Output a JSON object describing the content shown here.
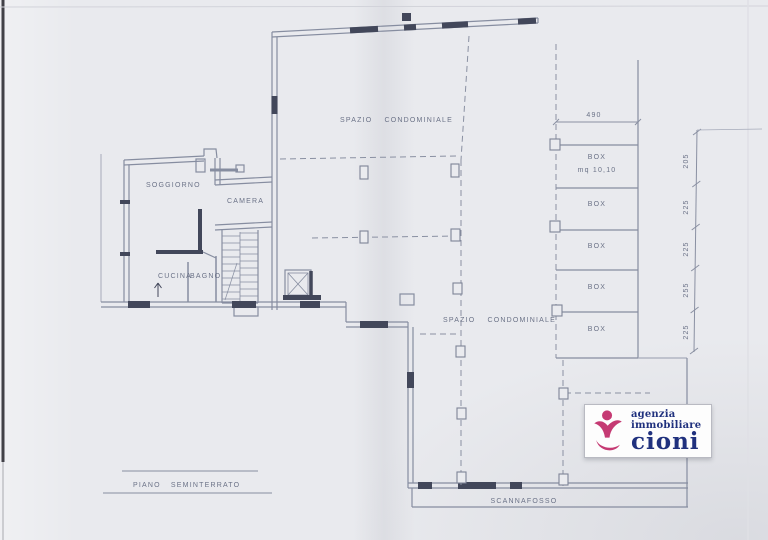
{
  "plan": {
    "title": "PIANO SEMINTERRATO",
    "rooms": {
      "soggiorno": "SOGGIORNO",
      "camera": "CAMERA",
      "cucina": "CUCINA",
      "bagno": "BAGNO"
    },
    "areas": {
      "spazio_upper": "SPAZIO CONDOMINIALE",
      "spazio_lower": "SPAZIO CONDOMINIALE",
      "scannafosso": "SCANNAFOSSO"
    },
    "boxes": [
      {
        "label": "BOX",
        "area": "mq 10,10"
      },
      {
        "label": "BOX",
        "area": ""
      },
      {
        "label": "BOX",
        "area": ""
      },
      {
        "label": "BOX",
        "area": ""
      },
      {
        "label": "BOX",
        "area": ""
      }
    ],
    "dimensions": {
      "top_width": "490",
      "right_heights": [
        "205",
        "225",
        "225",
        "255",
        "225"
      ]
    }
  },
  "logo": {
    "line1": "agenzia",
    "line2": "immobiliare",
    "name": "cioni",
    "colors": {
      "figure": "#c53a73",
      "text": "#20317e"
    }
  },
  "scan": {
    "paper_color": "#e9eaee",
    "line_color": "#868da0"
  }
}
